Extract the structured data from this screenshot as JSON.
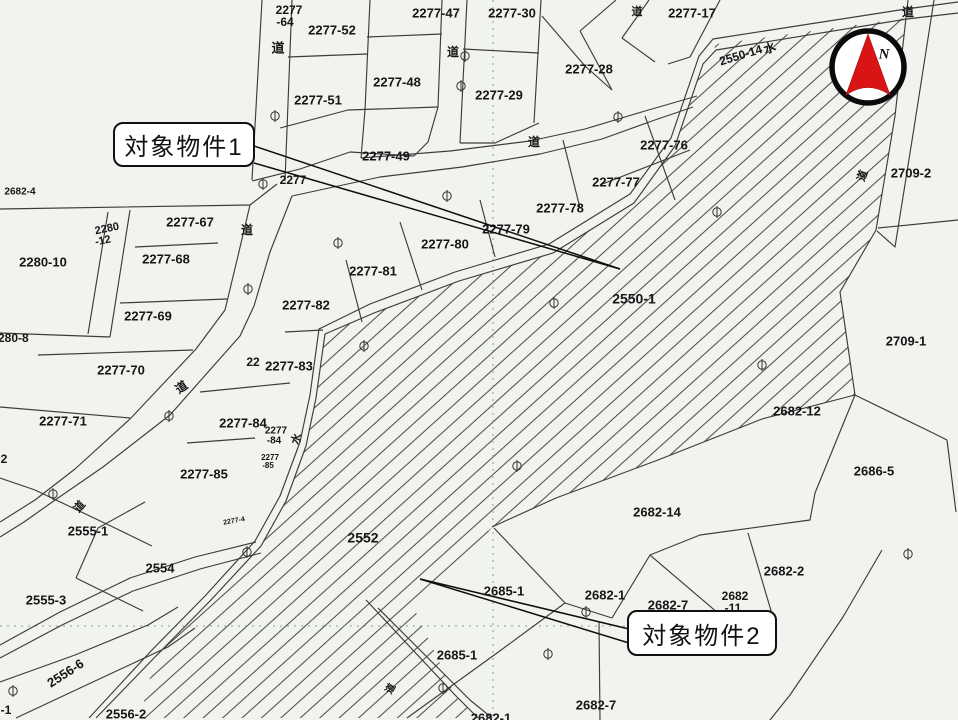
{
  "meta": {
    "type": "cadastral-map",
    "width": 958,
    "height": 720
  },
  "colors": {
    "paper": "#f1f3ef",
    "parcel_line": "#3c3c3c",
    "hatch_line": "#4e4e4e",
    "text": "#161616",
    "grid_dot": "#8a98a0",
    "compass_red": "#d81414",
    "callout_border": "#101010"
  },
  "compass": {
    "label": "N"
  },
  "callouts": [
    {
      "id": 1,
      "text": "対象物件1"
    },
    {
      "id": 2,
      "text": "対象物件2"
    }
  ],
  "labels": [
    {
      "t": "2277",
      "x": 289,
      "y": 11,
      "s": 12
    },
    {
      "t": "-64",
      "x": 285,
      "y": 23,
      "s": 12
    },
    {
      "t": "2277-52",
      "x": 332,
      "y": 31,
      "s": 13
    },
    {
      "t": "2277-47",
      "x": 436,
      "y": 14,
      "s": 13
    },
    {
      "t": "道",
      "x": 278,
      "y": 49,
      "s": 13,
      "role": "road"
    },
    {
      "t": "2277-48",
      "x": 397,
      "y": 83,
      "s": 13
    },
    {
      "t": "2277-51",
      "x": 318,
      "y": 101,
      "s": 13
    },
    {
      "t": "2277-49",
      "x": 386,
      "y": 157,
      "s": 13
    },
    {
      "t": "2277-30",
      "x": 512,
      "y": 14,
      "s": 13
    },
    {
      "t": "道",
      "x": 453,
      "y": 53,
      "s": 12,
      "role": "road"
    },
    {
      "t": "2277-29",
      "x": 499,
      "y": 96,
      "s": 13
    },
    {
      "t": "2277-28",
      "x": 589,
      "y": 70,
      "s": 13
    },
    {
      "t": "道",
      "x": 534,
      "y": 143,
      "s": 12,
      "role": "road"
    },
    {
      "t": "2277-17",
      "x": 692,
      "y": 14,
      "s": 13
    },
    {
      "t": "道",
      "x": 637,
      "y": 12,
      "s": 11,
      "role": "road"
    },
    {
      "t": "2550-14",
      "x": 741,
      "y": 56,
      "s": 12,
      "r": -17
    },
    {
      "t": "水",
      "x": 770,
      "y": 49,
      "s": 12,
      "r": -20,
      "role": "water"
    },
    {
      "t": "道",
      "x": 908,
      "y": 13,
      "s": 12,
      "role": "road"
    },
    {
      "t": "2709-2",
      "x": 911,
      "y": 174,
      "s": 13
    },
    {
      "t": "道",
      "x": 863,
      "y": 176,
      "s": 11,
      "r": -70,
      "role": "road"
    },
    {
      "t": "2277-76",
      "x": 664,
      "y": 146,
      "s": 13
    },
    {
      "t": "2277-77",
      "x": 616,
      "y": 183,
      "s": 13
    },
    {
      "t": "2277",
      "x": 293,
      "y": 181,
      "s": 12
    },
    {
      "t": "2682-4",
      "x": 20,
      "y": 192,
      "s": 10
    },
    {
      "t": "2280",
      "x": 107,
      "y": 229,
      "s": 11,
      "r": -12
    },
    {
      "t": "-12",
      "x": 103,
      "y": 241,
      "s": 11,
      "r": -12
    },
    {
      "t": "2277-67",
      "x": 190,
      "y": 223,
      "s": 13
    },
    {
      "t": "道",
      "x": 247,
      "y": 231,
      "s": 12,
      "role": "road"
    },
    {
      "t": "2280-10",
      "x": 43,
      "y": 263,
      "s": 13
    },
    {
      "t": "2277-68",
      "x": 166,
      "y": 260,
      "s": 13
    },
    {
      "t": "2277-69",
      "x": 148,
      "y": 317,
      "s": 13
    },
    {
      "t": "2280-8",
      "x": 10,
      "y": 339,
      "s": 12
    },
    {
      "t": "2277-70",
      "x": 121,
      "y": 371,
      "s": 13
    },
    {
      "t": "2277-71",
      "x": 63,
      "y": 422,
      "s": 13
    },
    {
      "t": "2",
      "x": 4,
      "y": 460,
      "s": 12
    },
    {
      "t": "道",
      "x": 182,
      "y": 388,
      "s": 12,
      "r": -35,
      "role": "road"
    },
    {
      "t": "22",
      "x": 253,
      "y": 363,
      "s": 12
    },
    {
      "t": "2277-83",
      "x": 289,
      "y": 367,
      "s": 13
    },
    {
      "t": "2277-82",
      "x": 306,
      "y": 306,
      "s": 13
    },
    {
      "t": "2277-81",
      "x": 373,
      "y": 272,
      "s": 13
    },
    {
      "t": "2277-80",
      "x": 445,
      "y": 245,
      "s": 13
    },
    {
      "t": "2277-79",
      "x": 506,
      "y": 230,
      "s": 13
    },
    {
      "t": "2277-78",
      "x": 560,
      "y": 209,
      "s": 13
    },
    {
      "t": "2277-84",
      "x": 243,
      "y": 424,
      "s": 13
    },
    {
      "t": "2277",
      "x": 276,
      "y": 431,
      "s": 10
    },
    {
      "t": "-84",
      "x": 274,
      "y": 441,
      "s": 10
    },
    {
      "t": "水",
      "x": 297,
      "y": 439,
      "s": 11,
      "r": -72,
      "role": "water"
    },
    {
      "t": "2277",
      "x": 270,
      "y": 458,
      "s": 8
    },
    {
      "t": "-85",
      "x": 268,
      "y": 466,
      "s": 8
    },
    {
      "t": "2277-85",
      "x": 204,
      "y": 475,
      "s": 13
    },
    {
      "t": "2550-1",
      "x": 634,
      "y": 300,
      "s": 14
    },
    {
      "t": "2552",
      "x": 363,
      "y": 539,
      "s": 14
    },
    {
      "t": "2709-1",
      "x": 906,
      "y": 342,
      "s": 13
    },
    {
      "t": "2682-12",
      "x": 797,
      "y": 412,
      "s": 13
    },
    {
      "t": "2686-5",
      "x": 874,
      "y": 472,
      "s": 13
    },
    {
      "t": "2682-14",
      "x": 657,
      "y": 513,
      "s": 13
    },
    {
      "t": "2682-2",
      "x": 784,
      "y": 572,
      "s": 13
    },
    {
      "t": "2682",
      "x": 735,
      "y": 597,
      "s": 12
    },
    {
      "t": "-11",
      "x": 733,
      "y": 609,
      "s": 12
    },
    {
      "t": "2682-7",
      "x": 668,
      "y": 606,
      "s": 13
    },
    {
      "t": "2682-1",
      "x": 605,
      "y": 596,
      "s": 13
    },
    {
      "t": "2685-1",
      "x": 504,
      "y": 592,
      "s": 13
    },
    {
      "t": "2685-1",
      "x": 457,
      "y": 656,
      "s": 13
    },
    {
      "t": "2682-1",
      "x": 491,
      "y": 719,
      "s": 13
    },
    {
      "t": "2682-7",
      "x": 596,
      "y": 706,
      "s": 13
    },
    {
      "t": "2555-1",
      "x": 88,
      "y": 532,
      "s": 13
    },
    {
      "t": "2554",
      "x": 160,
      "y": 569,
      "s": 13
    },
    {
      "t": "2555-3",
      "x": 46,
      "y": 601,
      "s": 13
    },
    {
      "t": "2556-6",
      "x": 66,
      "y": 674,
      "s": 13,
      "r": -33
    },
    {
      "t": "-1",
      "x": 6,
      "y": 711,
      "s": 12
    },
    {
      "t": "2556-2",
      "x": 126,
      "y": 715,
      "s": 13
    },
    {
      "t": "道",
      "x": 391,
      "y": 689,
      "s": 10,
      "r": -60,
      "role": "road"
    },
    {
      "t": "道",
      "x": 80,
      "y": 507,
      "s": 11,
      "r": -50,
      "role": "road"
    },
    {
      "t": "2277-4",
      "x": 234,
      "y": 521,
      "s": 7,
      "r": -10
    }
  ],
  "markers": [
    [
      465,
      56
    ],
    [
      461,
      86
    ],
    [
      275,
      116
    ],
    [
      263,
      184
    ],
    [
      338,
      243
    ],
    [
      248,
      289
    ],
    [
      364,
      346
    ],
    [
      554,
      303
    ],
    [
      717,
      212
    ],
    [
      762,
      365
    ],
    [
      618,
      117
    ],
    [
      447,
      196
    ],
    [
      169,
      416
    ],
    [
      53,
      494
    ],
    [
      247,
      552
    ],
    [
      13,
      691
    ],
    [
      517,
      466
    ],
    [
      586,
      612
    ],
    [
      548,
      654
    ],
    [
      443,
      688
    ],
    [
      908,
      554
    ]
  ]
}
